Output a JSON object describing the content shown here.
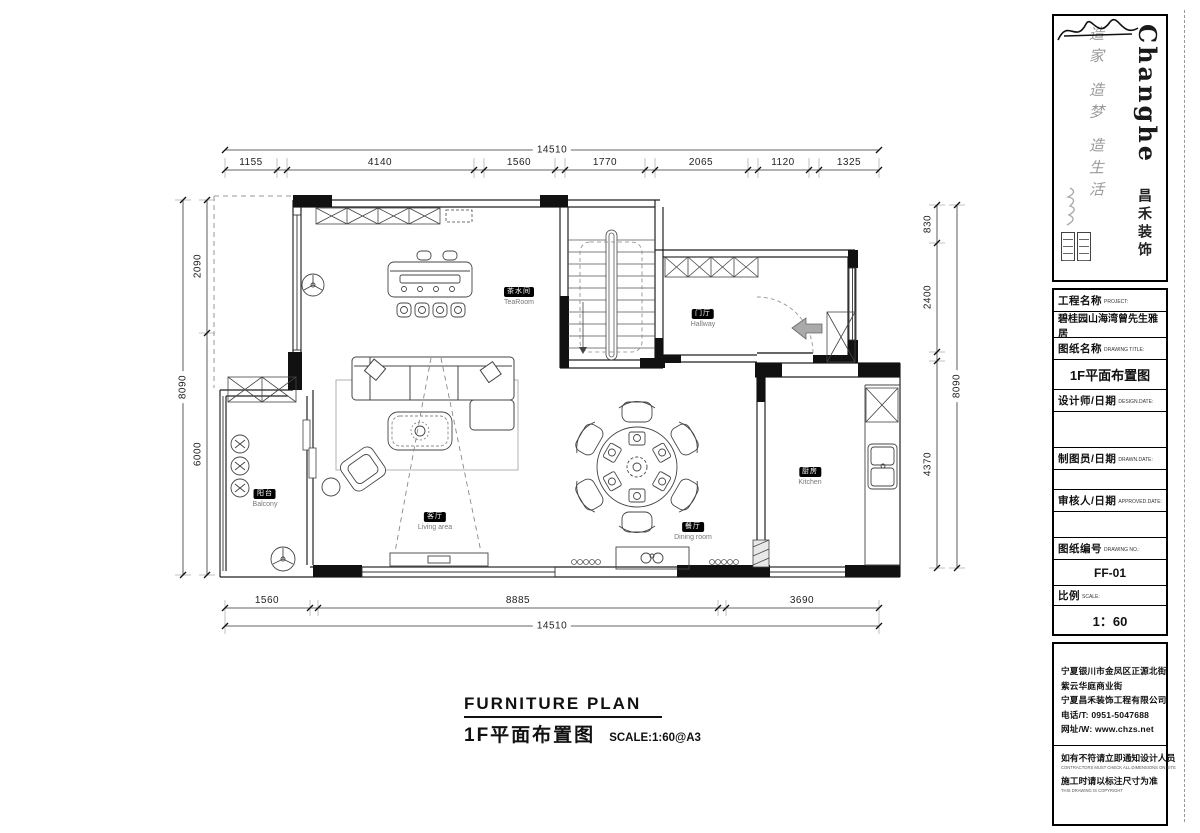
{
  "sheet": {
    "title_en": "FURNITURE PLAN",
    "title_cn": "1F平面布置图",
    "scale_note": "SCALE:1:60@A3"
  },
  "logo": {
    "brand": "Changhe",
    "brand_cn": "昌禾装饰",
    "motto": "造家 造梦 造生活"
  },
  "title_block": {
    "project_label": "工程名称",
    "project_label_en": "PROJECT:",
    "project_name": "碧桂园山海湾曾先生雅居",
    "drawing_label": "图纸名称",
    "drawing_label_en": "DRAWING TITLE:",
    "drawing_title": "1F平面布置图",
    "designer_label": "设计师/日期",
    "designer_label_en": "DESIGN.DATE:",
    "drafter_label": "制图员/日期",
    "drafter_label_en": "DRAWN.DATE:",
    "approver_label": "审核人/日期",
    "approver_label_en": "APPROVED.DATE:",
    "number_label": "图纸编号",
    "number_label_en": "DRAWING NO.:",
    "drawing_number": "FF-01",
    "scale_label": "比例",
    "scale_label_en": "SCALE:",
    "scale_value": "1：60"
  },
  "company": {
    "address_1": "宁夏银川市金凤区正源北街",
    "address_2": "紫云华庭商业街",
    "name": "宁夏昌禾装饰工程有限公司",
    "phone": "电话/T: 0951-5047688",
    "website": "网址/W: www.chzs.net",
    "notice_1": "如有不符请立即通知设计人员",
    "notice_1_en": "CONTRACTORS MUST CHECK ALL DIMENSIONS ON SITE",
    "notice_2": "施工时请以标注尺寸为准",
    "notice_2_en": "THIS DRAWING IS COPYRIGHT"
  },
  "rooms": {
    "tearoom": {
      "cn": "茶水间",
      "en": "TeaRoom"
    },
    "hallway": {
      "cn": "门厅",
      "en": "Hallway"
    },
    "kitchen": {
      "cn": "厨房",
      "en": "Kitchen"
    },
    "balcony": {
      "cn": "阳台",
      "en": "Balcony"
    },
    "living": {
      "cn": "客厅",
      "en": "Living area"
    },
    "dining": {
      "cn": "餐厅",
      "en": "Dining room"
    }
  },
  "dimensions": {
    "top": {
      "overall": "14510",
      "segments": [
        "1155",
        "4140",
        "1560",
        "1770",
        "2065",
        "1120",
        "1325"
      ]
    },
    "bottom": {
      "overall": "14510",
      "segments": [
        "1560",
        "8885",
        "3690"
      ]
    },
    "left": {
      "overall": "8090",
      "segments": [
        "2090",
        "6000"
      ]
    },
    "right": {
      "overall": "8090",
      "segments": [
        "830",
        "2400",
        "4370"
      ]
    }
  }
}
